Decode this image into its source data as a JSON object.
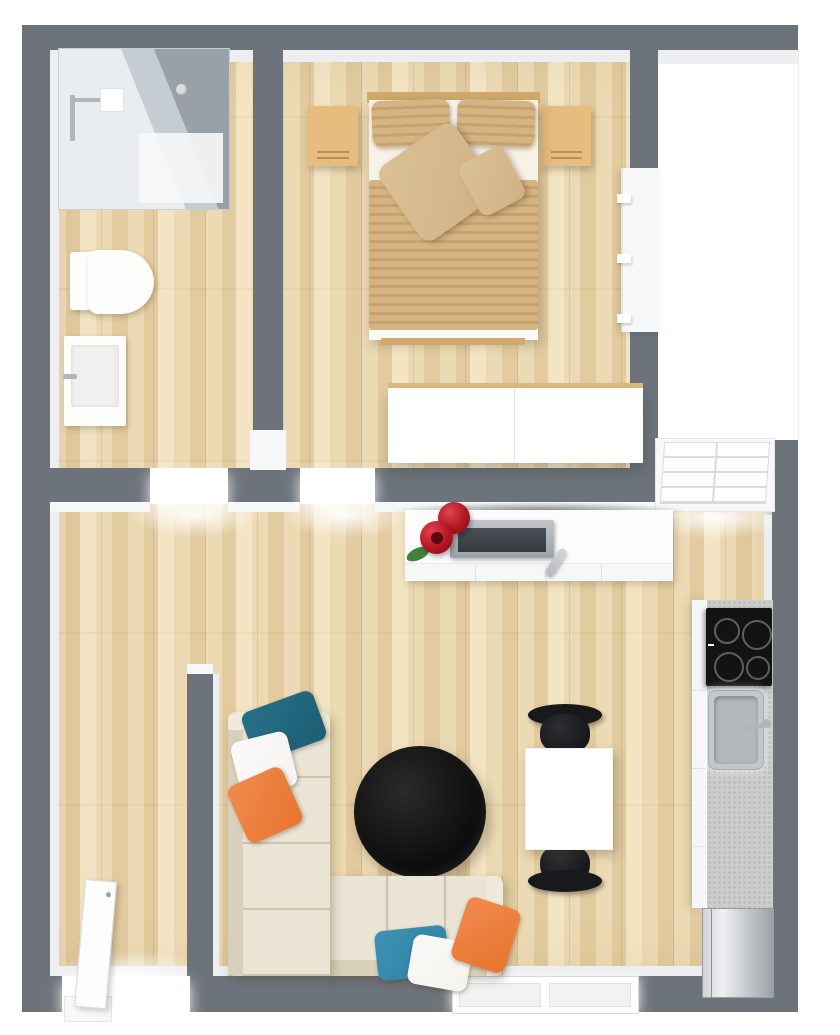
{
  "scene": {
    "type": "3d-floor-plan",
    "view": "top-down-render",
    "rooms": [
      {
        "name": "bathroom",
        "position": "top-left",
        "items": [
          "walk-in-glass-shower",
          "chrome-shower-fixture",
          "toilet",
          "sink-vanity",
          "smoke-detector"
        ]
      },
      {
        "name": "bedroom",
        "position": "top-center",
        "items": [
          "double-bed-striped-tan-duvet",
          "two-head-pillows",
          "two-decor-cushions",
          "nightstand-left",
          "nightstand-right",
          "white-wall-shelf-unit",
          "white-dresser"
        ]
      },
      {
        "name": "living-room",
        "position": "bottom",
        "items": [
          "tv-console",
          "flat-tv",
          "red-vase-with-flower",
          "red-vase",
          "remote-control",
          "round-black-coffee-table",
          "l-shaped-cream-sofa",
          "teal-white-orange-pillows",
          "white-dining-table",
          "two-black-chairs"
        ]
      },
      {
        "name": "kitchenette",
        "position": "bottom-right",
        "items": [
          "four-burner-cooktop",
          "stainless-sink-with-faucet",
          "speckled-countertop",
          "cabinet-fronts",
          "steel-fridge"
        ]
      },
      {
        "name": "balcony-strip",
        "position": "right",
        "items": []
      }
    ],
    "openings": {
      "entrance_door": "bottom-left, white leaf open into room",
      "bathroom_door": "threshold in hall wall, left",
      "bedroom_door": "threshold in hall wall, right",
      "window_east": "upper-right of living room, white sash with slats",
      "window_south": "bottom wall, double white frame"
    },
    "counts": {
      "sofa_pillows": 6,
      "cooktop_burners": 4,
      "dining_chairs": 2,
      "nightstands": 2,
      "red_vases": 2
    }
  },
  "colors": {
    "wall": "#6d737b",
    "wallFace": "#eceef0",
    "faceBright": "#f6f7f8",
    "bright": "#ffffff",
    "floorA": "#ecdab4",
    "floorB": "#e2cb9f",
    "floorC": "#f3e5c4",
    "glassDark": "#99a1a8",
    "glassMid": "#c6cdd2",
    "showerBase": "#e9edef",
    "chrome": "#b0b6ba",
    "porcelain": "#fdfdfc",
    "nightstand": "#e6bd7e",
    "woodEdge": "#d2a96c",
    "sheet": "#f7f2e7",
    "duvetA": "#d5b383",
    "duvetB": "#c7a26d",
    "cushion": "#dcc196",
    "cushionB": "#d0b184",
    "shelfWhite": "#f7f8f9",
    "dresserTop": "#ddb97f",
    "console": "#fcfcfd",
    "tvScreen": "#3f444a",
    "vaseRed": "#b11622",
    "leafGreen": "#41803a",
    "remoteSilver": "#b7bbbe",
    "sofa": "#eae4d4",
    "sofaShade": "#d8d0bb",
    "sofaArm": "#f0eadd",
    "tealDark": "#1d5e72",
    "tealLight": "#2f7fa0",
    "orange": "#e9742f",
    "pillowWhite": "#f5f3ef",
    "tableBlack": "#0d0d0d",
    "chairBlack": "#18191b",
    "tableWhite": "#ffffff",
    "counter": "#cccccc",
    "counterDot": "#b3b3b3",
    "cooktop": "#131313",
    "burnerRing": "#5f5f5f",
    "steelA": "#d0d4d6",
    "steelB": "#9ba1a5",
    "sinkSteel": "#c1c7ca",
    "sinkInner": "#b3b9bc"
  }
}
